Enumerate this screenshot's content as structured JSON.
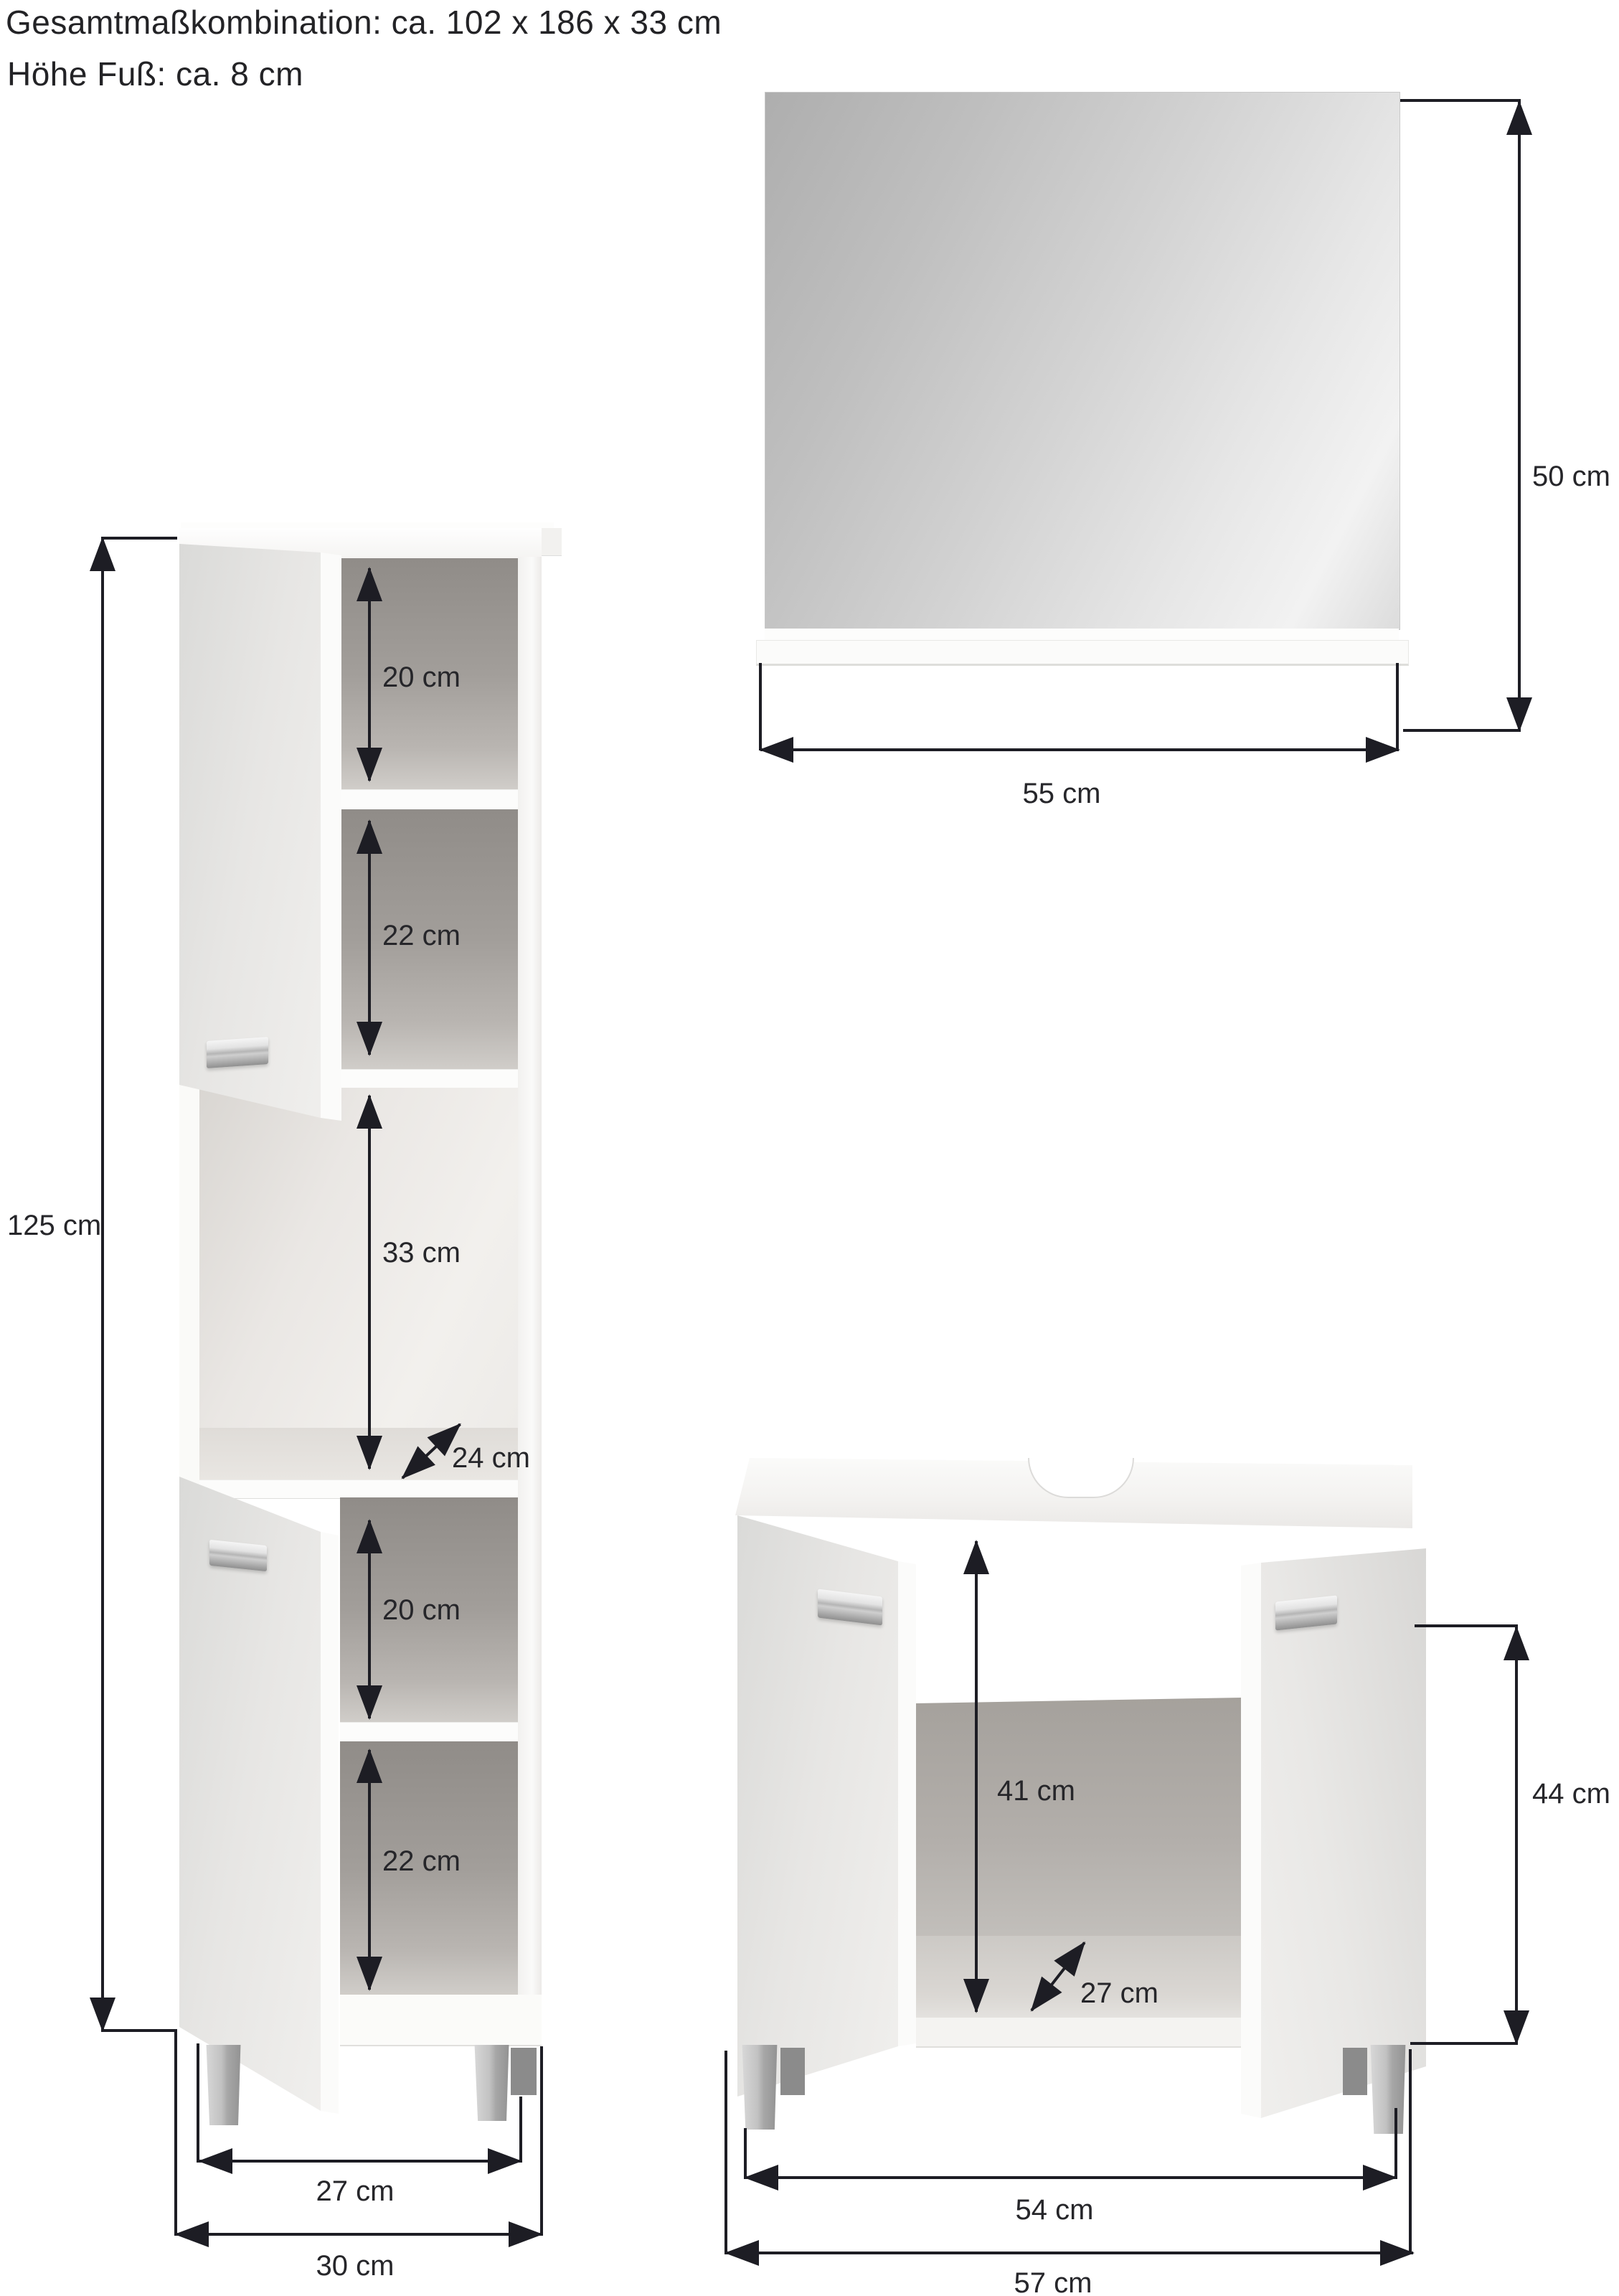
{
  "header": {
    "line1": "Gesamtmaßkombination: ca. 102 x 186 x 33 cm",
    "line2": "Höhe Fuß: ca. 8 cm"
  },
  "mirror": {
    "height": "50 cm",
    "width": "55 cm"
  },
  "tall_cabinet": {
    "height": "125 cm",
    "compartment1": "20 cm",
    "compartment2": "22 cm",
    "compartment3": "33 cm",
    "depth": "24 cm",
    "compartment4": "20 cm",
    "compartment5": "22 cm",
    "inner_width": "27 cm",
    "width": "30 cm"
  },
  "washbasin_cabinet": {
    "inner_height": "41 cm",
    "depth": "27 cm",
    "height": "44 cm",
    "inner_width": "54 cm",
    "width": "57 cm"
  },
  "colors": {
    "dimension_ink": "#1d1d24",
    "text": "#232326",
    "chrome_handle": "#b4b4b4",
    "interior_gray": "#a5a19d",
    "furniture_white": "#f3f2f0",
    "mirror_glass": "#c9c9c9"
  }
}
